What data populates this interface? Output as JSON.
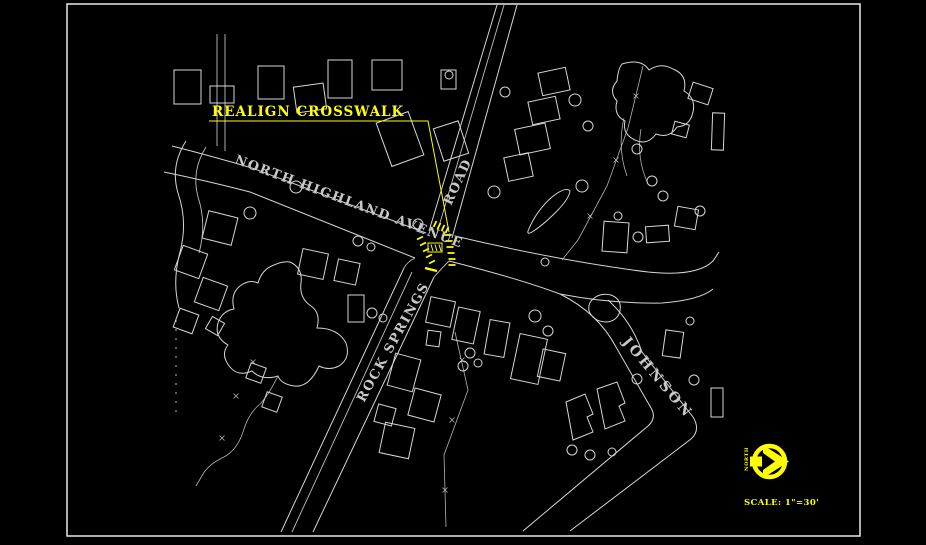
{
  "labels": {
    "annotation": "REALIGN CROSSWALK",
    "street_north_highland": "NORTH HIGHLAND AVENUE",
    "street_road": "ROAD",
    "street_rock_springs": "ROCK SPRINGS",
    "street_johnson": "JOHNSON",
    "north_arrow": "NORTH",
    "scale": "SCALE: 1\"=30'"
  },
  "colors": {
    "background": "#000000",
    "linework": "#d6d6d6",
    "street_text": "#c9c9c9",
    "highlight": "#ffff00",
    "frame": "#eaeaea"
  }
}
